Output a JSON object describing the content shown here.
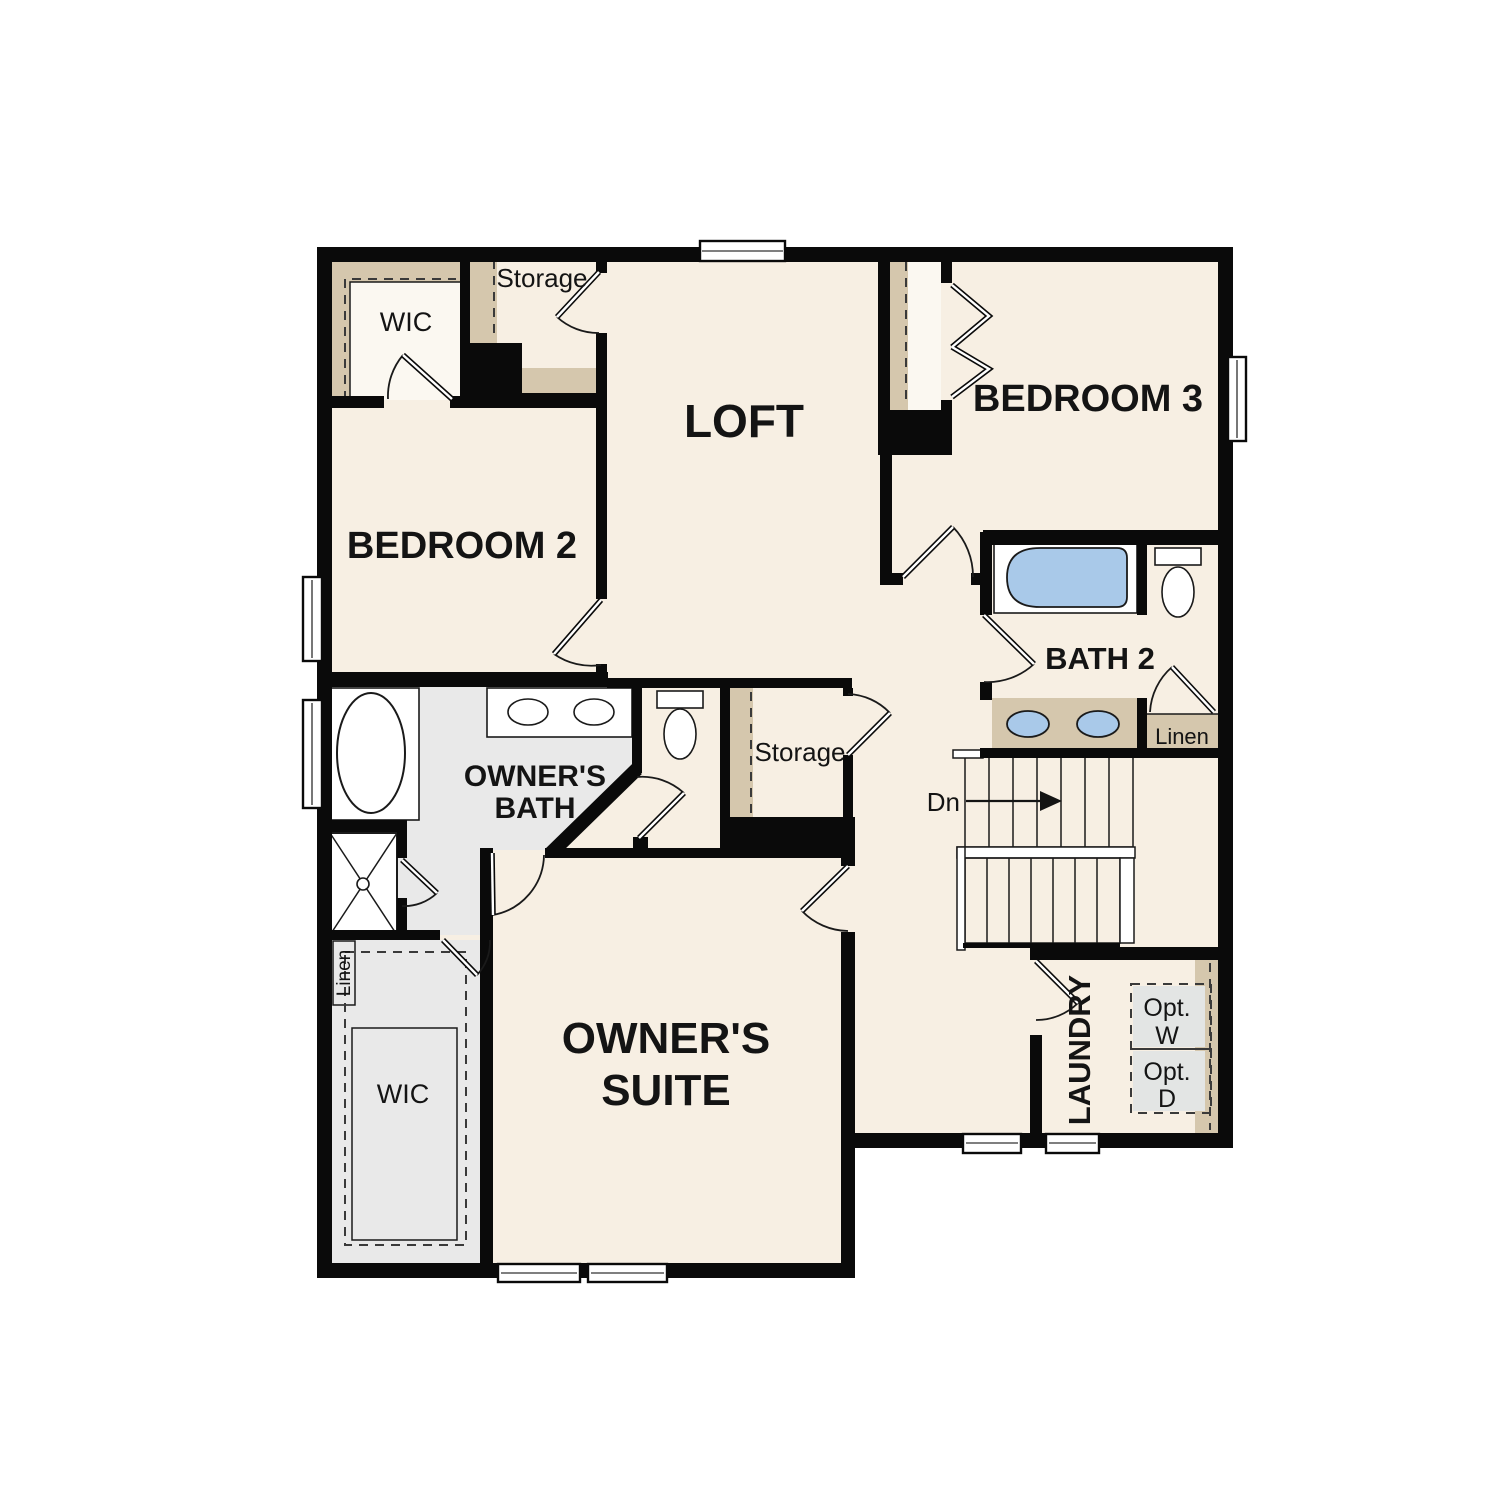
{
  "plan": {
    "labels": {
      "loft": "LOFT",
      "bedroom2": "BEDROOM 2",
      "bedroom3": "BEDROOM 3",
      "bath2": "BATH 2",
      "owners_bath": [
        "OWNER'S",
        "BATH"
      ],
      "owners_suite": [
        "OWNER'S",
        "SUITE"
      ],
      "laundry": "LAUNDRY",
      "wic_top": "WIC",
      "wic_bottom": "WIC",
      "storage_top": "Storage",
      "storage_mid": "Storage",
      "linen_bath2": "Linen",
      "linen_owner": "Linen",
      "stairs_down": "Dn",
      "opt_washer": [
        "Opt.",
        "W"
      ],
      "opt_dryer": [
        "Opt.",
        "D"
      ]
    },
    "colors": {
      "background": "#ffffff",
      "floor": "#f7efe3",
      "closet_floor": "#fbf8f1",
      "bath_floor": "#e9e9e9",
      "shelf_tan": "#d5c7ad",
      "wall": "#0a0a0a",
      "line": "#1a1a1a",
      "fixture_blue": "#a9c9e9",
      "optional_appliance_gray": "#e3e5e4"
    }
  }
}
